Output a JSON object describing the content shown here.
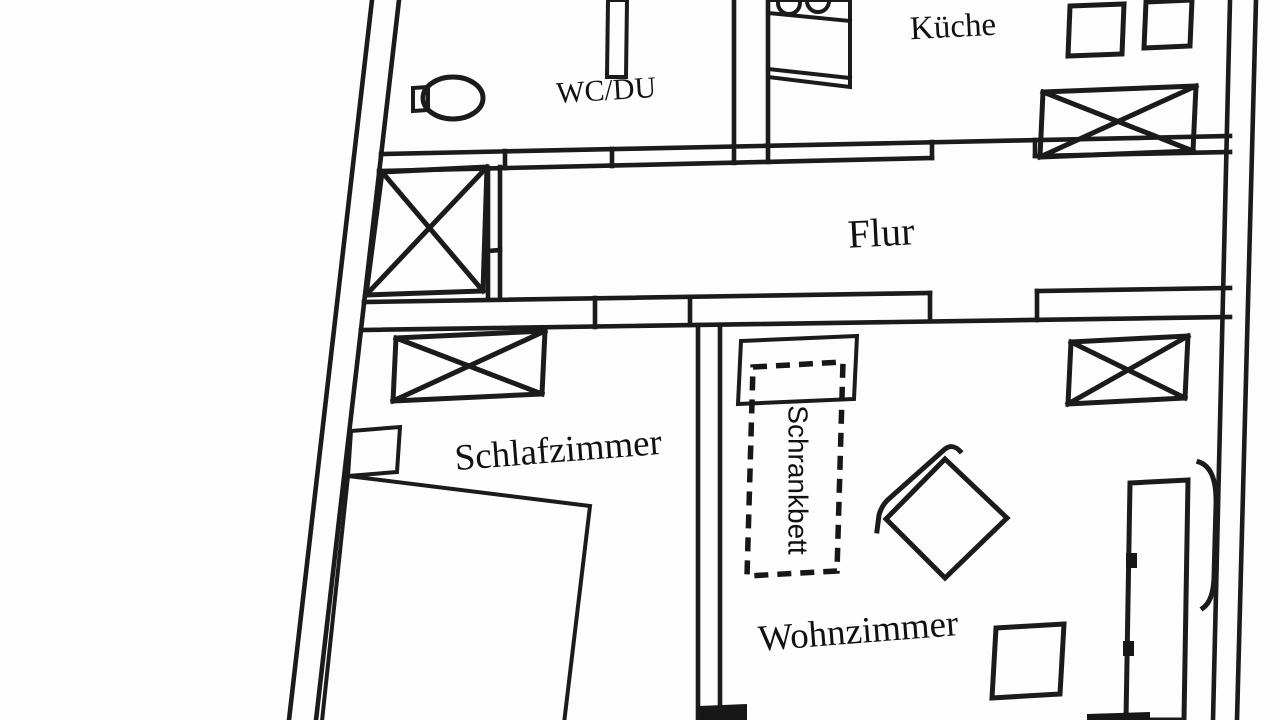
{
  "plan": {
    "type": "floor-plan",
    "rooms": {
      "wc": {
        "label": "WC/DU"
      },
      "kitchen": {
        "label": "Küche"
      },
      "hallway": {
        "label": "Flur"
      },
      "bedroom": {
        "label": "Schlafzimmer"
      },
      "living_room": {
        "label": "Wohnzimmer"
      }
    },
    "furniture": {
      "cabinet_bed": {
        "label": "Schrankbett"
      }
    },
    "colors": {
      "line": "#1e1e1e",
      "text": "#141414",
      "background": "#fdfdfd"
    }
  }
}
